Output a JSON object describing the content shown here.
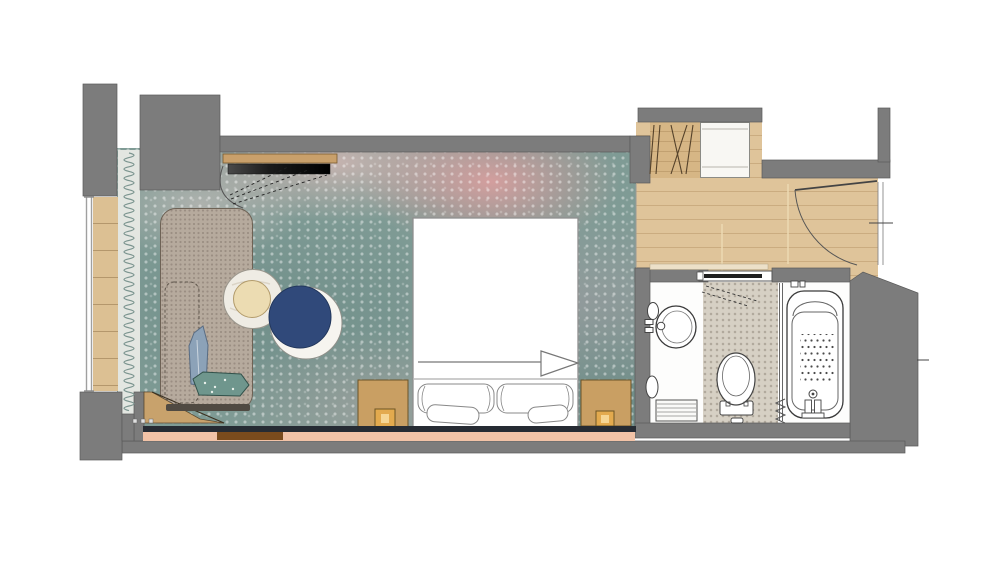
{
  "floorplan": {
    "scene": "hotel-guestroom-floor-plan",
    "rooms": [
      {
        "name": "bedroom",
        "floor": "patterned-carpet-teal-pink"
      },
      {
        "name": "entry-hall",
        "floor": "oak-plank"
      },
      {
        "name": "closet",
        "contents": [
          "hanging-rail",
          "white-cabinet"
        ]
      },
      {
        "name": "bathroom",
        "fixtures": [
          "washbasin",
          "toilet",
          "bathtub-with-shower",
          "towel-radiator",
          "glass-partition",
          "pocket-door"
        ]
      }
    ],
    "furniture": [
      "daybed-sofa",
      "chaise-cushion",
      "round-side-table",
      "round-armchair",
      "tv-on-wall-shelf",
      "double-bed",
      "bolster-pillows",
      "nightstand-left",
      "nightstand-right",
      "table-lamps",
      "window-curtain",
      "entry-door",
      "headboard-band",
      "decorative-pillows"
    ],
    "colors": {
      "wall": "#7c7c7c",
      "wall_outline": "#5a5a5a",
      "carpet_teal": "#7f9b95",
      "carpet_pink": "#d8a0a0",
      "wood_entry": "#dfc49a",
      "wood_closet": "#d6b685",
      "wood_sill": "#dcc093",
      "wood_shelf": "#c9a06b",
      "wood_wedge": "#c8a26c",
      "sofa": "#b6aa9d",
      "armchair_navy": "#30497a",
      "side_table_top": "#efece4",
      "side_table_inner": "#ecdcb2",
      "nightstand": "#c99f63",
      "lamp": "#e3aa4e",
      "tile": "#d6d0c4",
      "accent_pink_strip": "#f2c3a7",
      "accent_brown_strip": "#7a4b1d",
      "headboard": "#262b33",
      "fixture_line": "#3d3d3d",
      "tv_black": "#111111"
    }
  }
}
